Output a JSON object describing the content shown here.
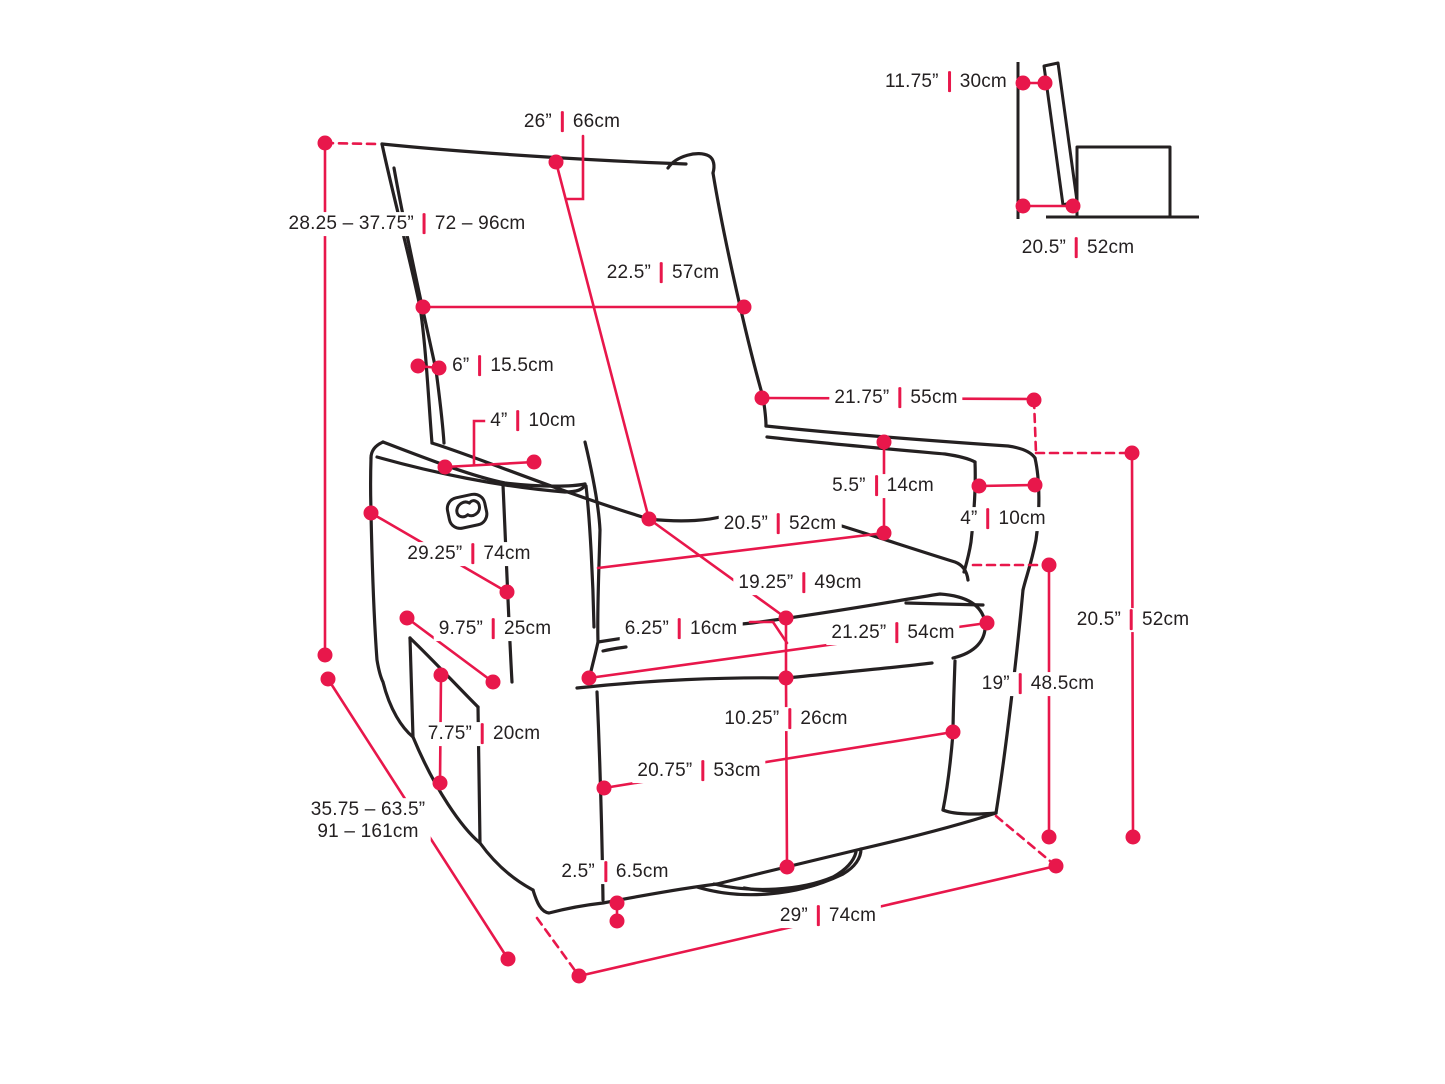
{
  "diagram": {
    "type": "product-dimension-diagram",
    "subject": "swivel-glider-recliner-chair",
    "accent_color": "#e8174b",
    "ink_color": "#242021",
    "separator": "|",
    "measurements": [
      {
        "id": "back-top-width",
        "in": "26”",
        "cm": "66cm",
        "x": 572,
        "y": 122,
        "layout": "inline"
      },
      {
        "id": "overall-height-range",
        "in": "28.25 – 37.75”",
        "cm": "72 – 96cm",
        "x": 407,
        "y": 224,
        "layout": "inline"
      },
      {
        "id": "backrest-width",
        "in": "22.5”",
        "cm": "57cm",
        "x": 663,
        "y": 273,
        "layout": "inline"
      },
      {
        "id": "backrest-thickness",
        "in": "6”",
        "cm": "15.5cm",
        "x": 503,
        "y": 366,
        "layout": "inline"
      },
      {
        "id": "left-armrest-width",
        "in": "4”",
        "cm": "10cm",
        "x": 533,
        "y": 421,
        "layout": "inline"
      },
      {
        "id": "inner-seat-width",
        "in": "21.75”",
        "cm": "55cm",
        "x": 896,
        "y": 398,
        "layout": "inline"
      },
      {
        "id": "arm-height-above-seat",
        "in": "5.5”",
        "cm": "14cm",
        "x": 883,
        "y": 486,
        "layout": "inline"
      },
      {
        "id": "right-armrest-width",
        "in": "4”",
        "cm": "10cm",
        "x": 1003,
        "y": 519,
        "layout": "inline"
      },
      {
        "id": "seat-width",
        "in": "20.5”",
        "cm": "52cm",
        "x": 780,
        "y": 524,
        "layout": "inline"
      },
      {
        "id": "overall-width-diagonal",
        "in": "29.25”",
        "cm": "74cm",
        "x": 469,
        "y": 554,
        "layout": "inline"
      },
      {
        "id": "seat-depth",
        "in": "19.25”",
        "cm": "49cm",
        "x": 800,
        "y": 583,
        "layout": "inline"
      },
      {
        "id": "arm-height-floor",
        "in": "20.5”",
        "cm": "52cm",
        "x": 1133,
        "y": 620,
        "layout": "inline"
      },
      {
        "id": "pocket-width",
        "in": "9.75”",
        "cm": "25cm",
        "x": 495,
        "y": 629,
        "layout": "inline"
      },
      {
        "id": "seat-cushion-thickness",
        "in": "6.25”",
        "cm": "16cm",
        "x": 681,
        "y": 629,
        "layout": "inline"
      },
      {
        "id": "base-front-width",
        "in": "21.25”",
        "cm": "54cm",
        "x": 893,
        "y": 633,
        "layout": "inline"
      },
      {
        "id": "seat-height",
        "in": "19”",
        "cm": "48.5cm",
        "x": 1038,
        "y": 684,
        "layout": "inline"
      },
      {
        "id": "pocket-height",
        "in": "7.75”",
        "cm": "20cm",
        "x": 484,
        "y": 734,
        "layout": "inline"
      },
      {
        "id": "base-height",
        "in": "10.25”",
        "cm": "26cm",
        "x": 786,
        "y": 719,
        "layout": "inline"
      },
      {
        "id": "base-depth",
        "in": "20.75”",
        "cm": "53cm",
        "x": 699,
        "y": 771,
        "layout": "inline"
      },
      {
        "id": "extended-depth-range",
        "in": "35.75 – 63.5”",
        "cm": "91 – 161cm",
        "x": 368,
        "y": 821,
        "layout": "stacked"
      },
      {
        "id": "base-clearance",
        "in": "2.5”",
        "cm": "6.5cm",
        "x": 615,
        "y": 872,
        "layout": "inline"
      },
      {
        "id": "overall-base-width",
        "in": "29”",
        "cm": "74cm",
        "x": 828,
        "y": 916,
        "layout": "inline"
      },
      {
        "id": "side-view-back-depth",
        "in": "11.75”",
        "cm": "30cm",
        "x": 946,
        "y": 82,
        "layout": "inline"
      },
      {
        "id": "side-view-seat-depth",
        "in": "20.5”",
        "cm": "52cm",
        "x": 1078,
        "y": 248,
        "layout": "inline"
      }
    ]
  }
}
